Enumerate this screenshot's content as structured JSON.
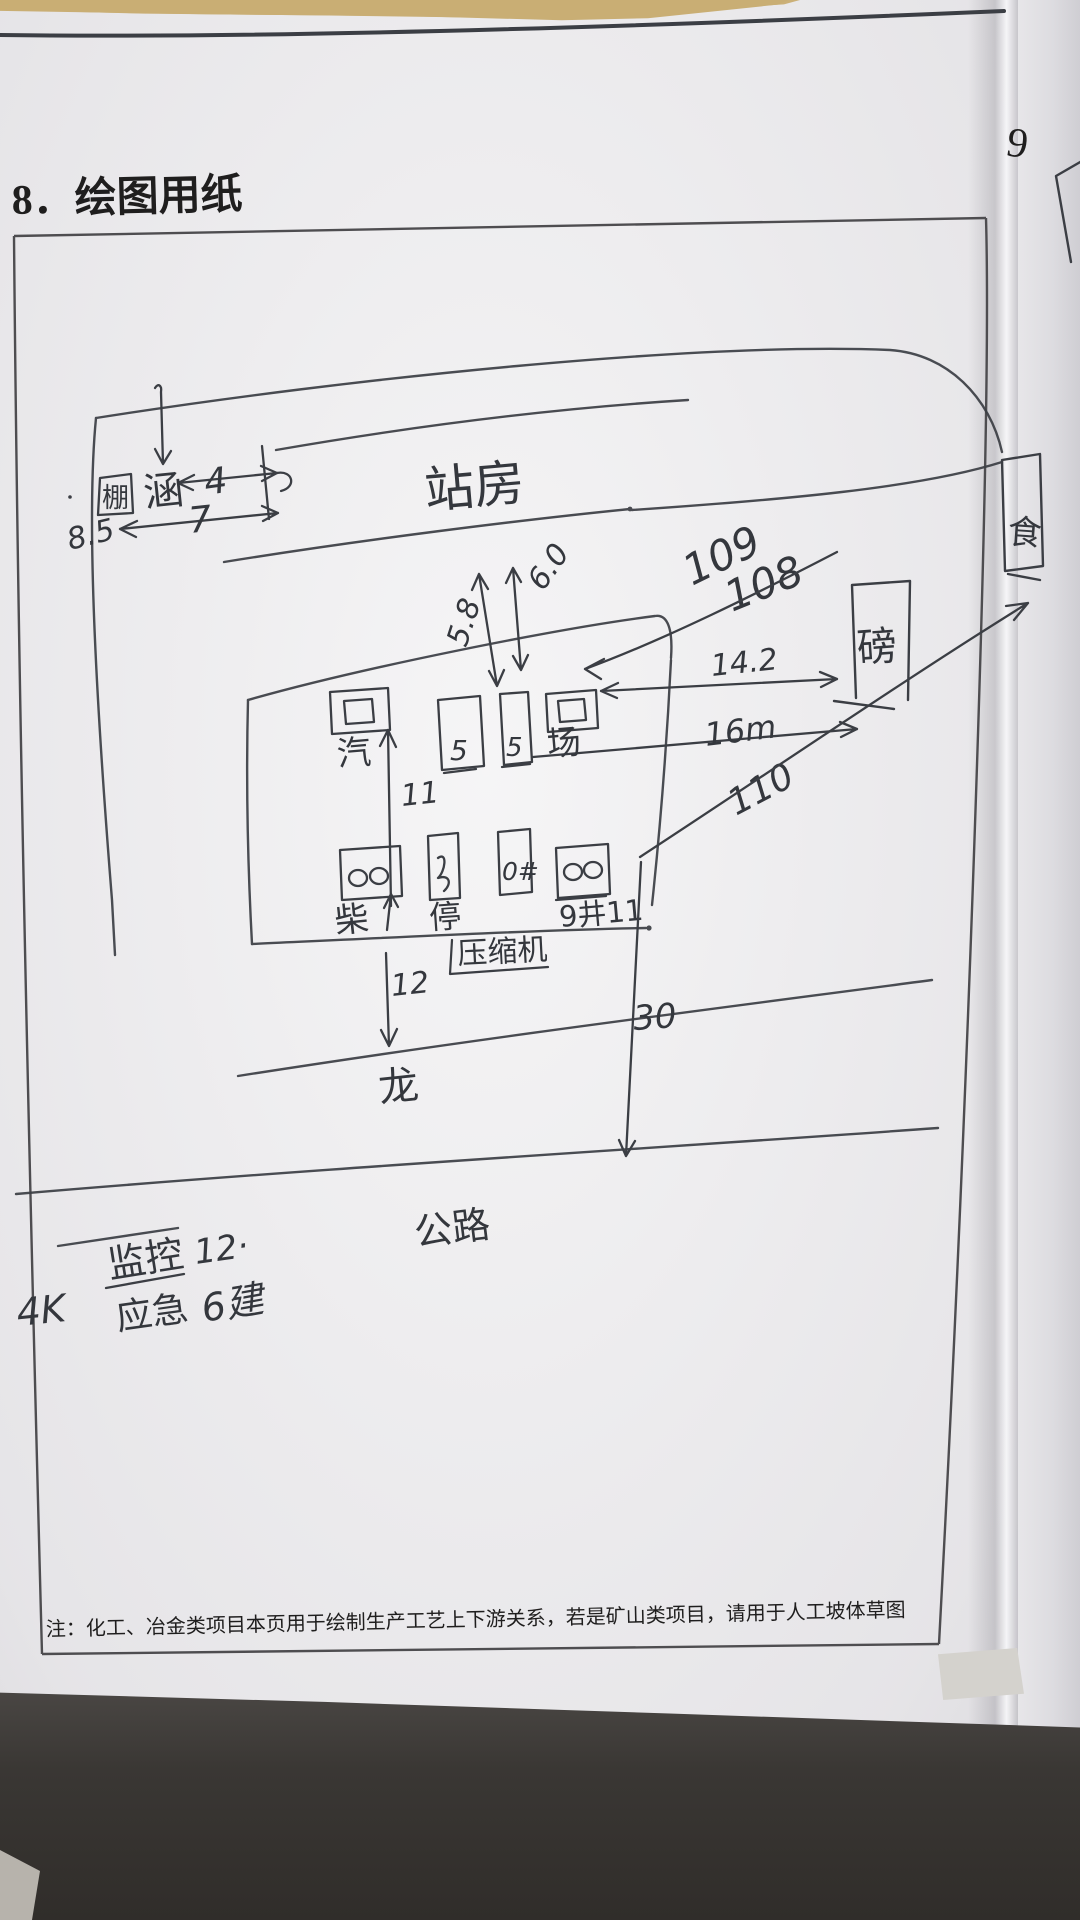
{
  "page": {
    "heading": "8．绘图用纸",
    "footnote": "注：化工、冶金类项目本页用于绘制生产工艺上下游关系，若是矿山类项目，请用于人工坡体草图",
    "next_page_number": "9"
  },
  "sketch": {
    "labels": {
      "station": "站房",
      "culvert": "涵",
      "shed": "棚",
      "canteen": "食",
      "scale_house": "磅",
      "steam_box": "汽",
      "yard_box": "场",
      "tank_mark_a": "5",
      "tank_mark_b": "5",
      "diesel": "柴",
      "parking": "停",
      "well_zero": "0#",
      "well_nine": "9井11",
      "compressor": "压缩机",
      "dike": "龙",
      "road": "公路"
    },
    "dimensions": {
      "d_8_5": "8.5",
      "d_4": "4",
      "d_7": "7",
      "d_5_8": "5.8",
      "d_6_0": "6.0",
      "d_14_2": "14.2",
      "d_16m": "16m",
      "d_11": "11",
      "d_12": "12",
      "d_30": "30"
    },
    "elevations": {
      "e_109": "109",
      "e_108": "108",
      "e_110": "110"
    },
    "notes": {
      "monitor": "监控",
      "monitor_count": "12·",
      "camera_spec": "4K",
      "emergency": "应急",
      "emergency_count": "6建"
    }
  }
}
